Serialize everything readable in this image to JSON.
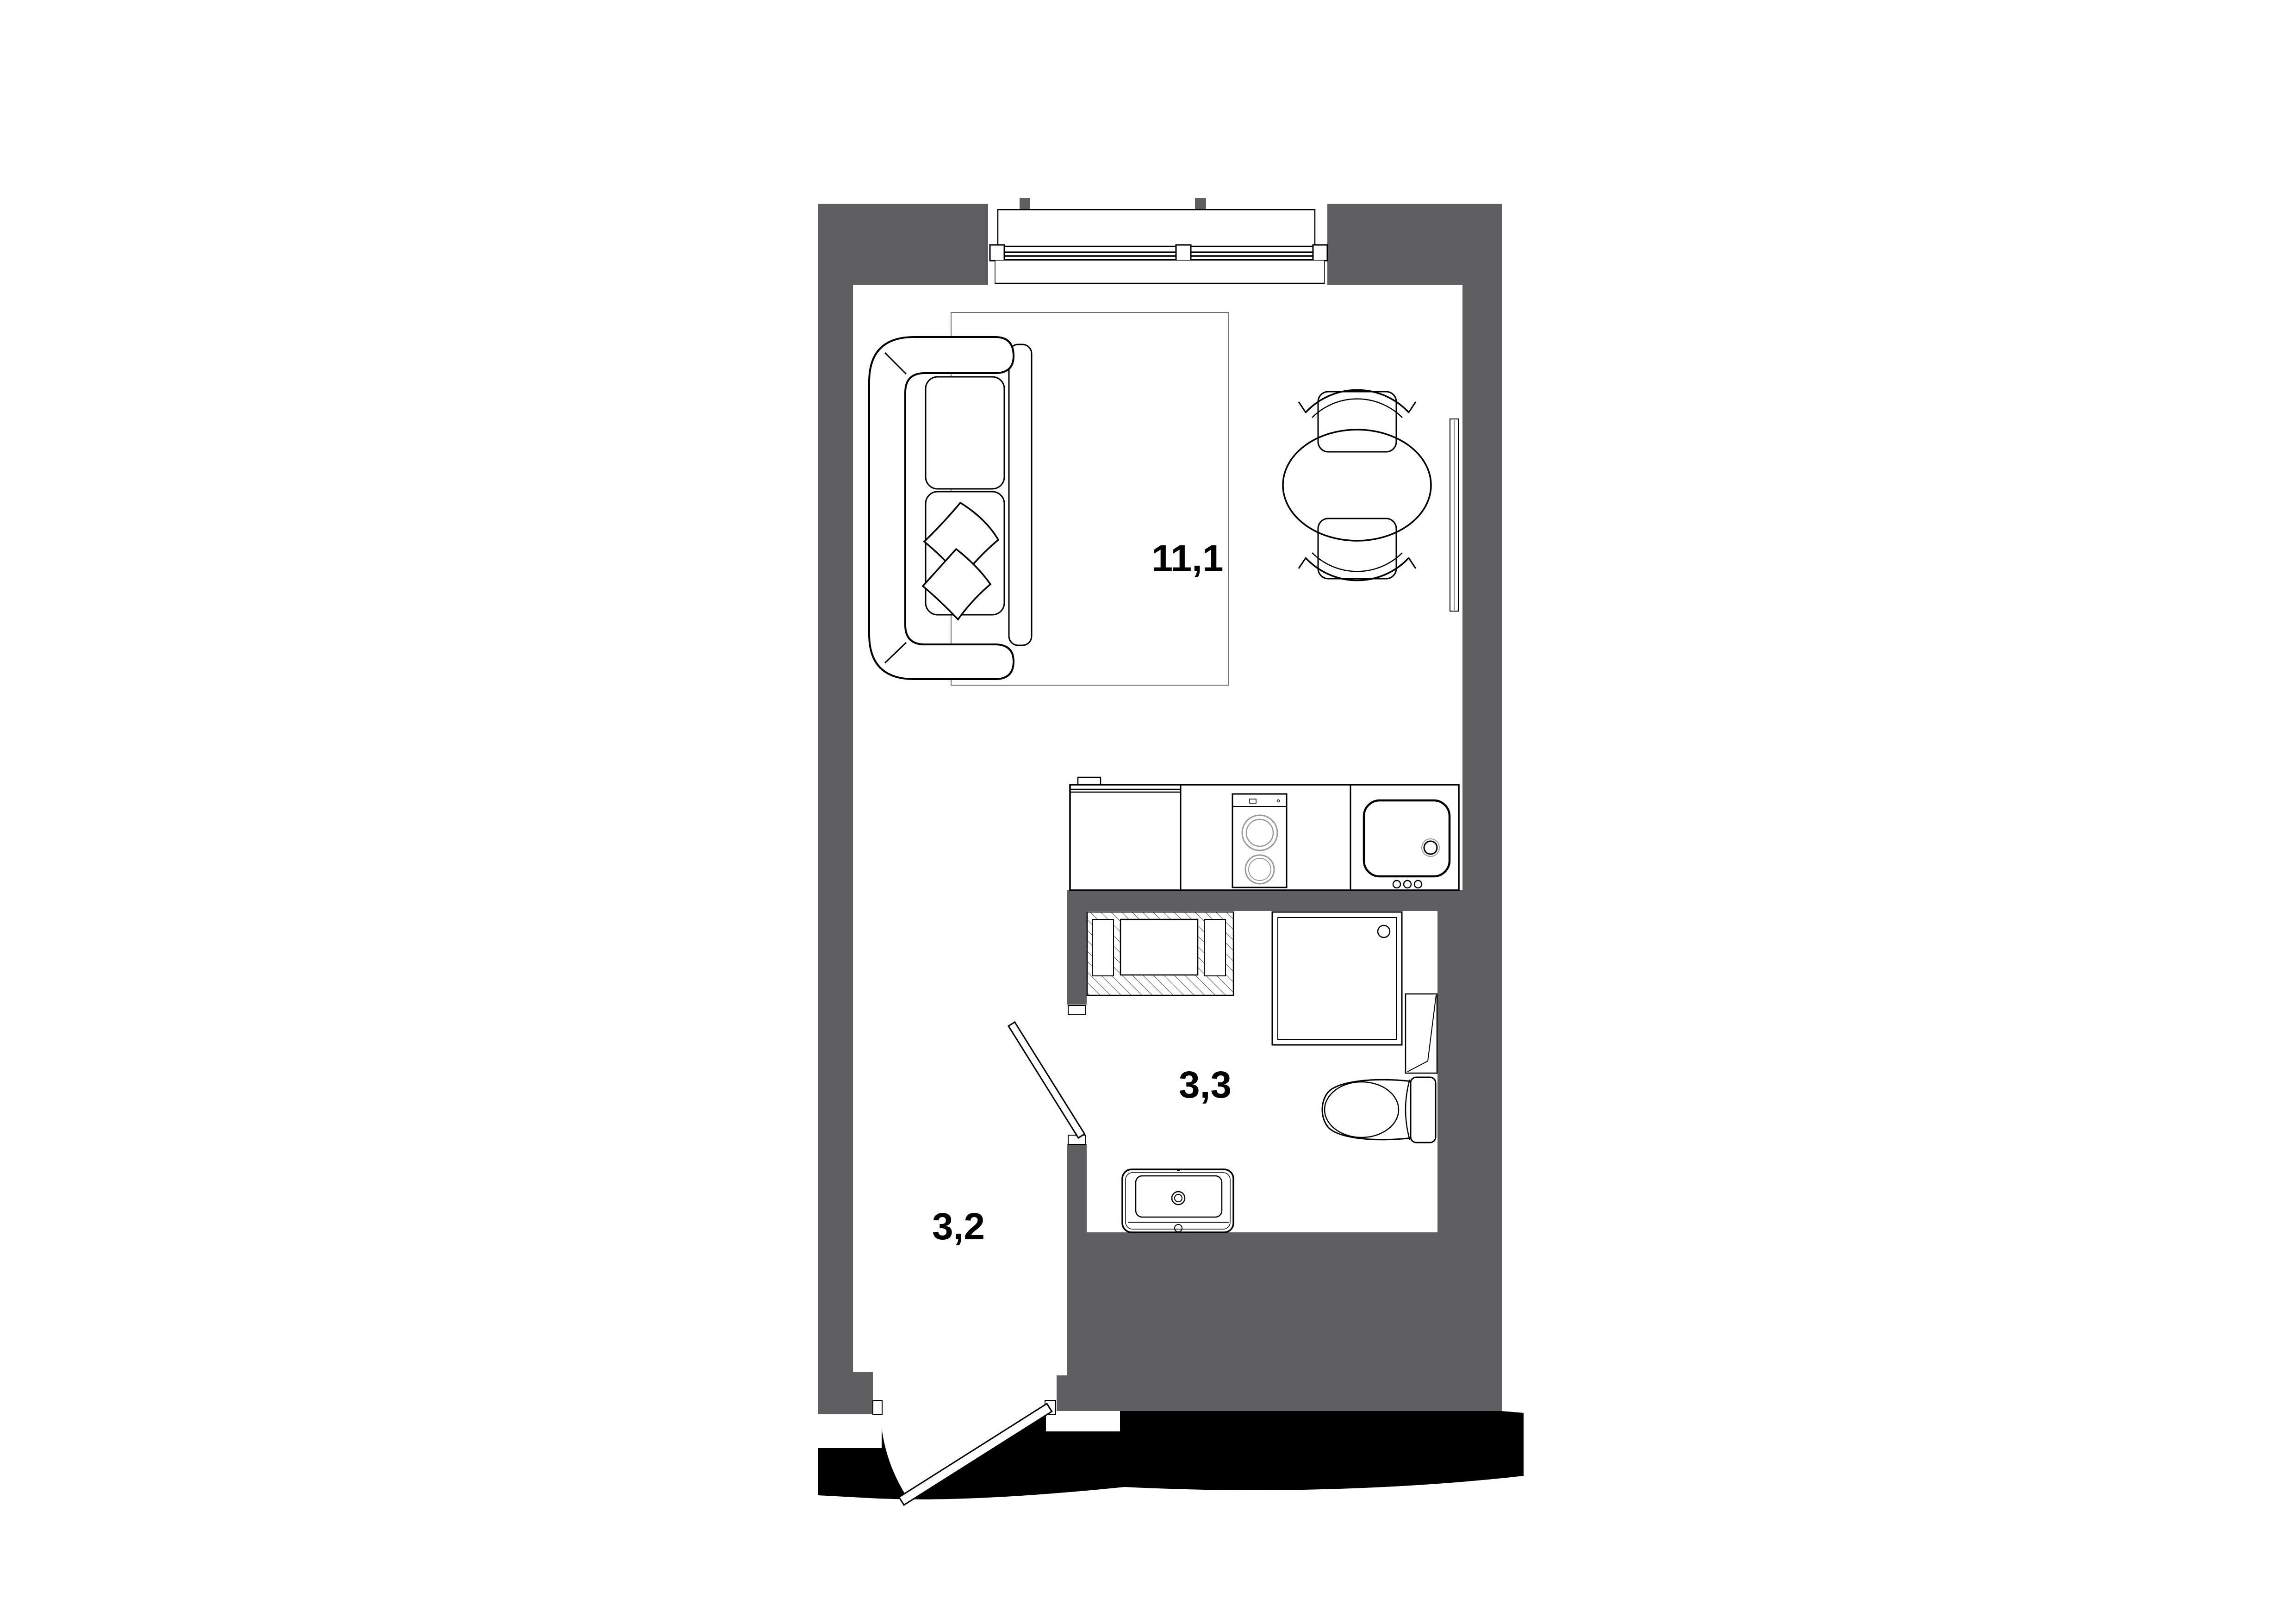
{
  "plan": {
    "type": "apartment-floor-plan",
    "rooms": [
      {
        "id": "living-kitchen",
        "area_label": "11,1"
      },
      {
        "id": "bathroom",
        "area_label": "3,3"
      },
      {
        "id": "hallway",
        "area_label": "3,2"
      }
    ],
    "colors": {
      "wall": "#5f5f61",
      "line": "#000000",
      "floor": "#ffffff",
      "exterior": "#000000",
      "appliance_detail": "#999999",
      "rug": "#6f6f6f",
      "hatch": "#444444"
    },
    "label_font_size": 82
  }
}
